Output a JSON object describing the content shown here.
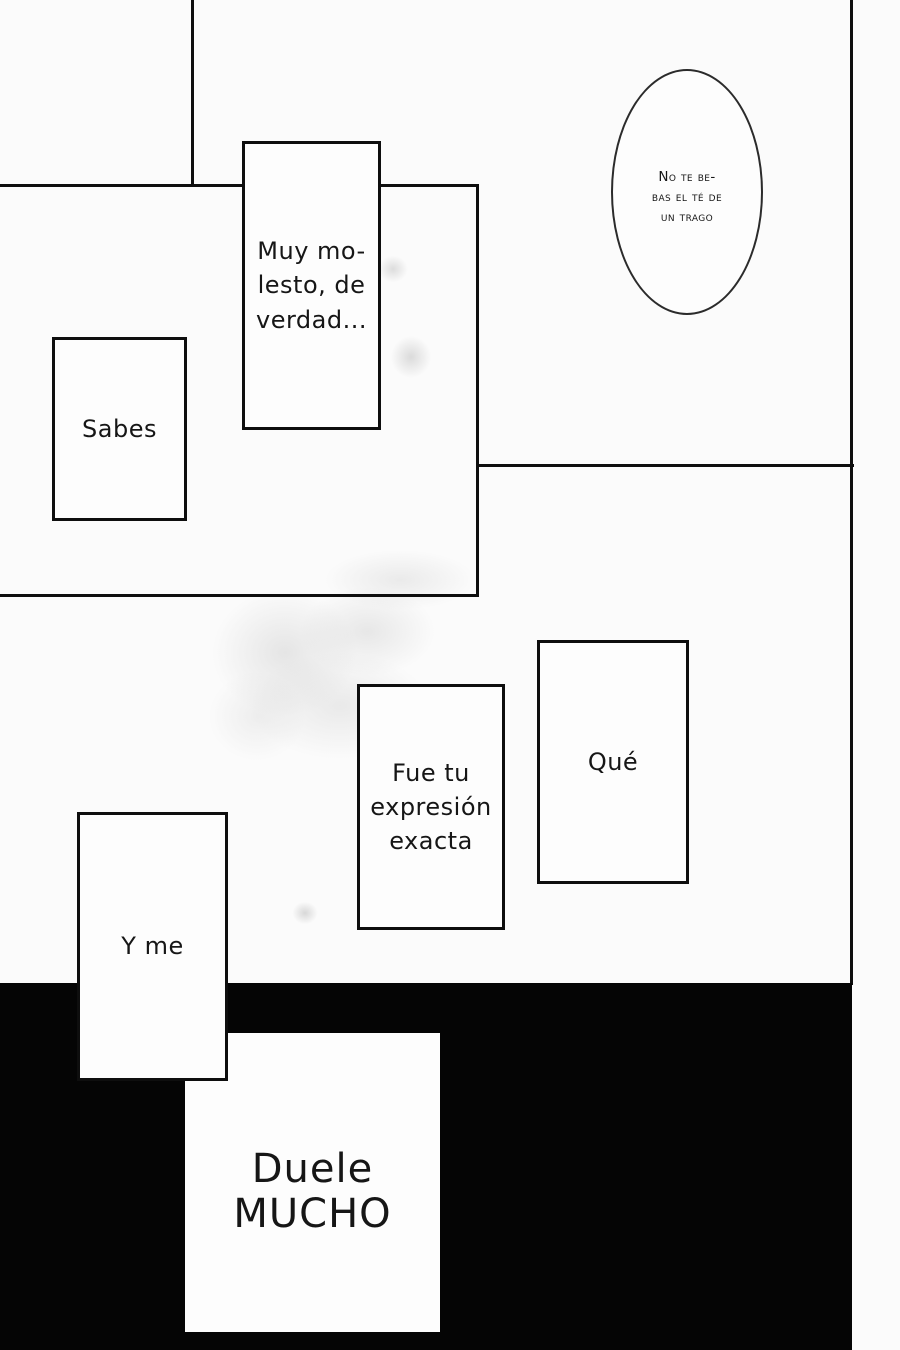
{
  "page": {
    "background_color": "#fbfbfb",
    "ink_color": "#0e0e0e",
    "fill_region_color": "#050505"
  },
  "bubbles": {
    "tea": {
      "lines": [
        "No te be-",
        "bas el té de",
        "un trago"
      ]
    },
    "muy": {
      "lines": [
        "Muy mo-",
        "lesto, de",
        "verdad..."
      ]
    },
    "sabes": {
      "lines": [
        "Sabes"
      ]
    },
    "que": {
      "lines": [
        "Qué"
      ]
    },
    "fue": {
      "lines": [
        "Fue tu",
        "expresión",
        "exacta"
      ]
    },
    "yme": {
      "lines": [
        "Y me"
      ]
    },
    "duele": {
      "lines": [
        "Duele",
        "MUCHO"
      ]
    }
  }
}
